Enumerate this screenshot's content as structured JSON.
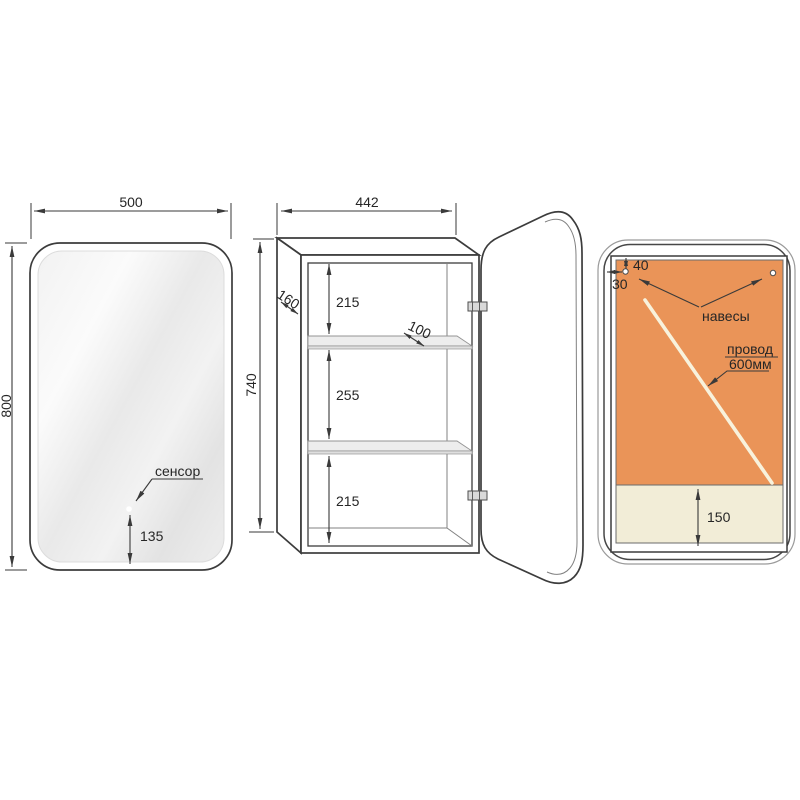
{
  "front_view": {
    "width": "500",
    "height": "800",
    "sensor_label": "сенсор",
    "sensor_height": "135"
  },
  "open_view": {
    "width": "442",
    "height": "740",
    "depth": "160",
    "top_gap": "215",
    "shelf_depth": "100",
    "middle_gap": "255",
    "bottom_gap": "215"
  },
  "back_view": {
    "hanger_offset_top": "40",
    "hanger_offset_side": "30",
    "hangers_label": "навесы",
    "wire_label_line1": "провод",
    "wire_label_line2": "600мм",
    "bottom_zone_height": "150"
  },
  "colors": {
    "back_panel": "#EA9458",
    "bottom_panel": "#F2EDD7",
    "line": "#3C3C3C"
  }
}
